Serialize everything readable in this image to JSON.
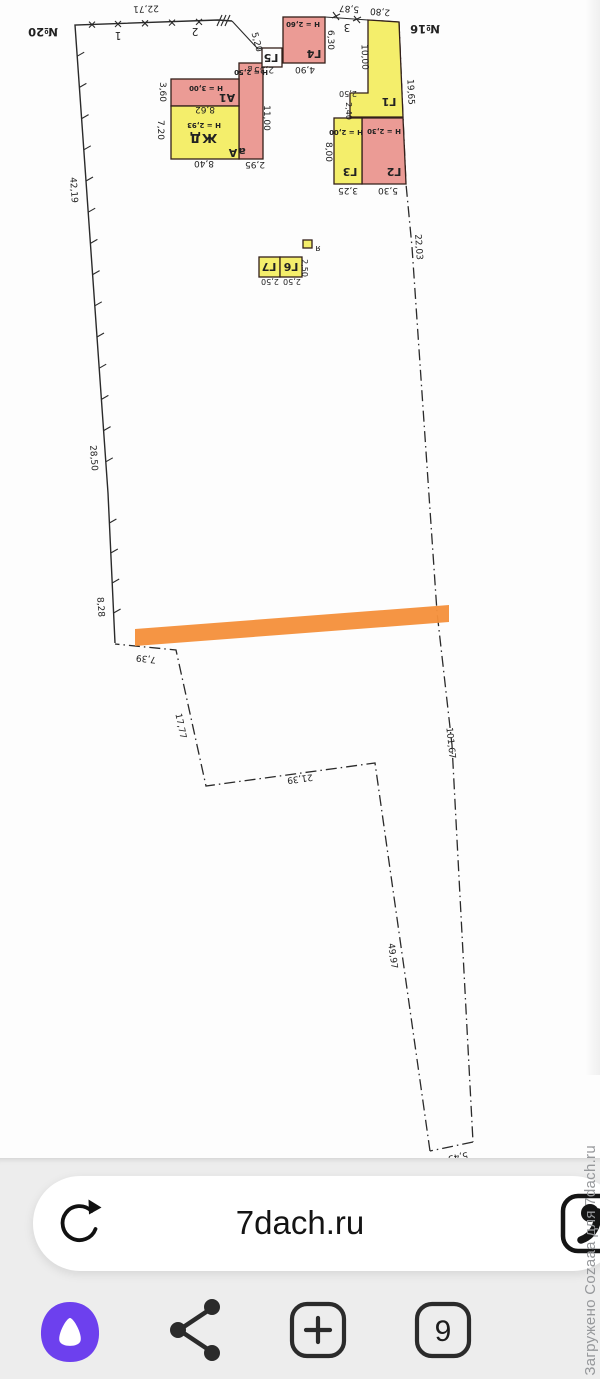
{
  "plan": {
    "neighbor_left": "№20",
    "neighbor_right": "№16",
    "points": {
      "p1": "1",
      "p2": "2",
      "p3": "3"
    },
    "boundary": {
      "top": "22,71",
      "top_right_1": "5,87",
      "top_right_2": "2,80",
      "left_1": "42,19",
      "left_2": "28,50",
      "left_3": "8,28",
      "bottom_1": "7,39",
      "bottom_2": "17,77",
      "bottom_3": "21,39",
      "bottom_4": "49,97",
      "bottom_tip": "5,43",
      "right_1": "19,65",
      "right_2": "22,03",
      "right_3": "101,67"
    },
    "buildings": {
      "zhd": {
        "label": "ЖД",
        "height": "Н = 2,93",
        "litera": "А",
        "w": "8,40",
        "side": "7,20",
        "top": "8,62"
      },
      "a1": {
        "label": "А1",
        "height": "Н = 3,00",
        "side": "3,60"
      },
      "a_small": {
        "label": "а",
        "height": "Н = 2,50",
        "len": "11,00",
        "w": "2,95"
      },
      "g5": {
        "label": "Г5",
        "side": "5,20",
        "w": "2,35",
        "porch": "в"
      },
      "g4": {
        "label": "Г4",
        "height": "Н = 2,60",
        "w": "4,90",
        "side": "6,30"
      },
      "g1": {
        "label": "Г1",
        "len": "10,00",
        "w1": "2,50",
        "w2": "2,40"
      },
      "g2": {
        "label": "Г2",
        "height": "Н = 2,30",
        "w": "5,30"
      },
      "g3": {
        "label": "Г3",
        "height": "Н = 2,00",
        "side": "8,00",
        "w": "3,25"
      },
      "g6": {
        "label": "Г6",
        "w": "2,50"
      },
      "g7": {
        "label": "Г7",
        "w": "2,50",
        "side": "2,50"
      },
      "ya": {
        "label": "я"
      }
    },
    "highlight_color": "#f5913c",
    "brick_fill": "#eb9b95",
    "wood_fill": "#f4ee6b"
  },
  "browser": {
    "url": "7dach.ru",
    "tabs_count": "9",
    "accent_color": "#6d40ee",
    "icons": {
      "left_of_url": "refresh-icon",
      "right_of_url": "reader-mode-icon",
      "toolbar": [
        "alice-icon",
        "share-icon",
        "new-tab-icon",
        "tabs-icon"
      ]
    }
  },
  "watermark": "Загружено Cozaaa для 7dach.ru"
}
